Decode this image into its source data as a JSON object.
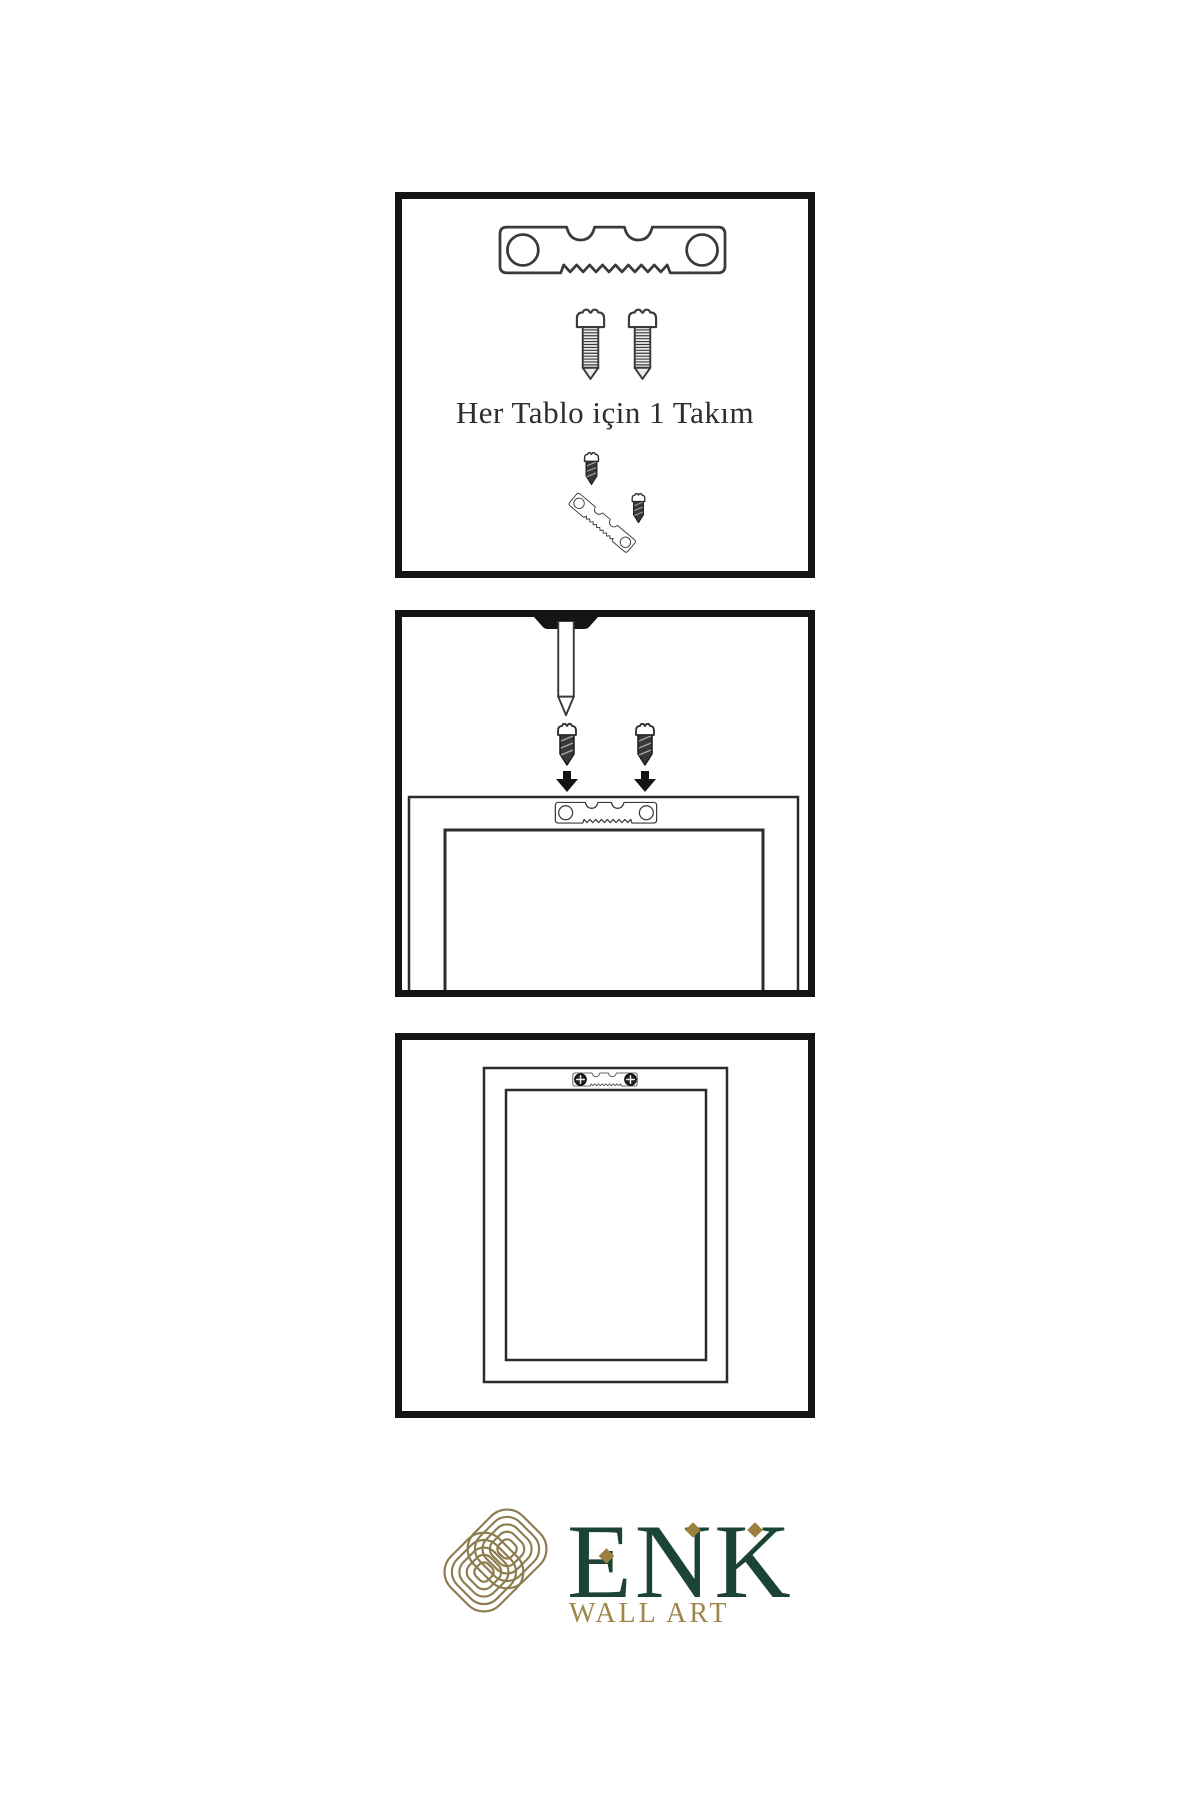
{
  "page": {
    "width": 1200,
    "height": 1800,
    "background": "#ffffff"
  },
  "steps": {
    "step1": {
      "caption": "Her Tablo için 1 Takım"
    },
    "step2": {
      "caption": ""
    },
    "step3": {
      "caption": ""
    }
  },
  "brand": {
    "name": "ENK",
    "tagline": "WALL ART"
  },
  "colors": {
    "panel_border": "#141414",
    "line": "#3a3a3a",
    "brand_green": "#1c4434",
    "brand_gold": "#9e8549",
    "diamond_gold": "#99803f",
    "knot_gold": "#8d7c4e"
  },
  "icons": {
    "sawtooth-hanger-icon": "metal sawtooth picture hanger bar with two screw holes",
    "threaded-screw-icon": "slotted pan-head wood screw, threaded shank",
    "small-screw-icon": "small dark slotted screw",
    "wall-nail-icon": "nail driven into wall from top edge",
    "down-arrow-icon": "solid black downward arrow",
    "frame-back-icon": "rear view of picture frame with hanger mounted",
    "framed-picture-icon": "hung picture frame front view",
    "phillips-screw-head-icon": "round phillips screw head",
    "brand-knot-icon": "interlaced rounded-square knot emblem"
  }
}
